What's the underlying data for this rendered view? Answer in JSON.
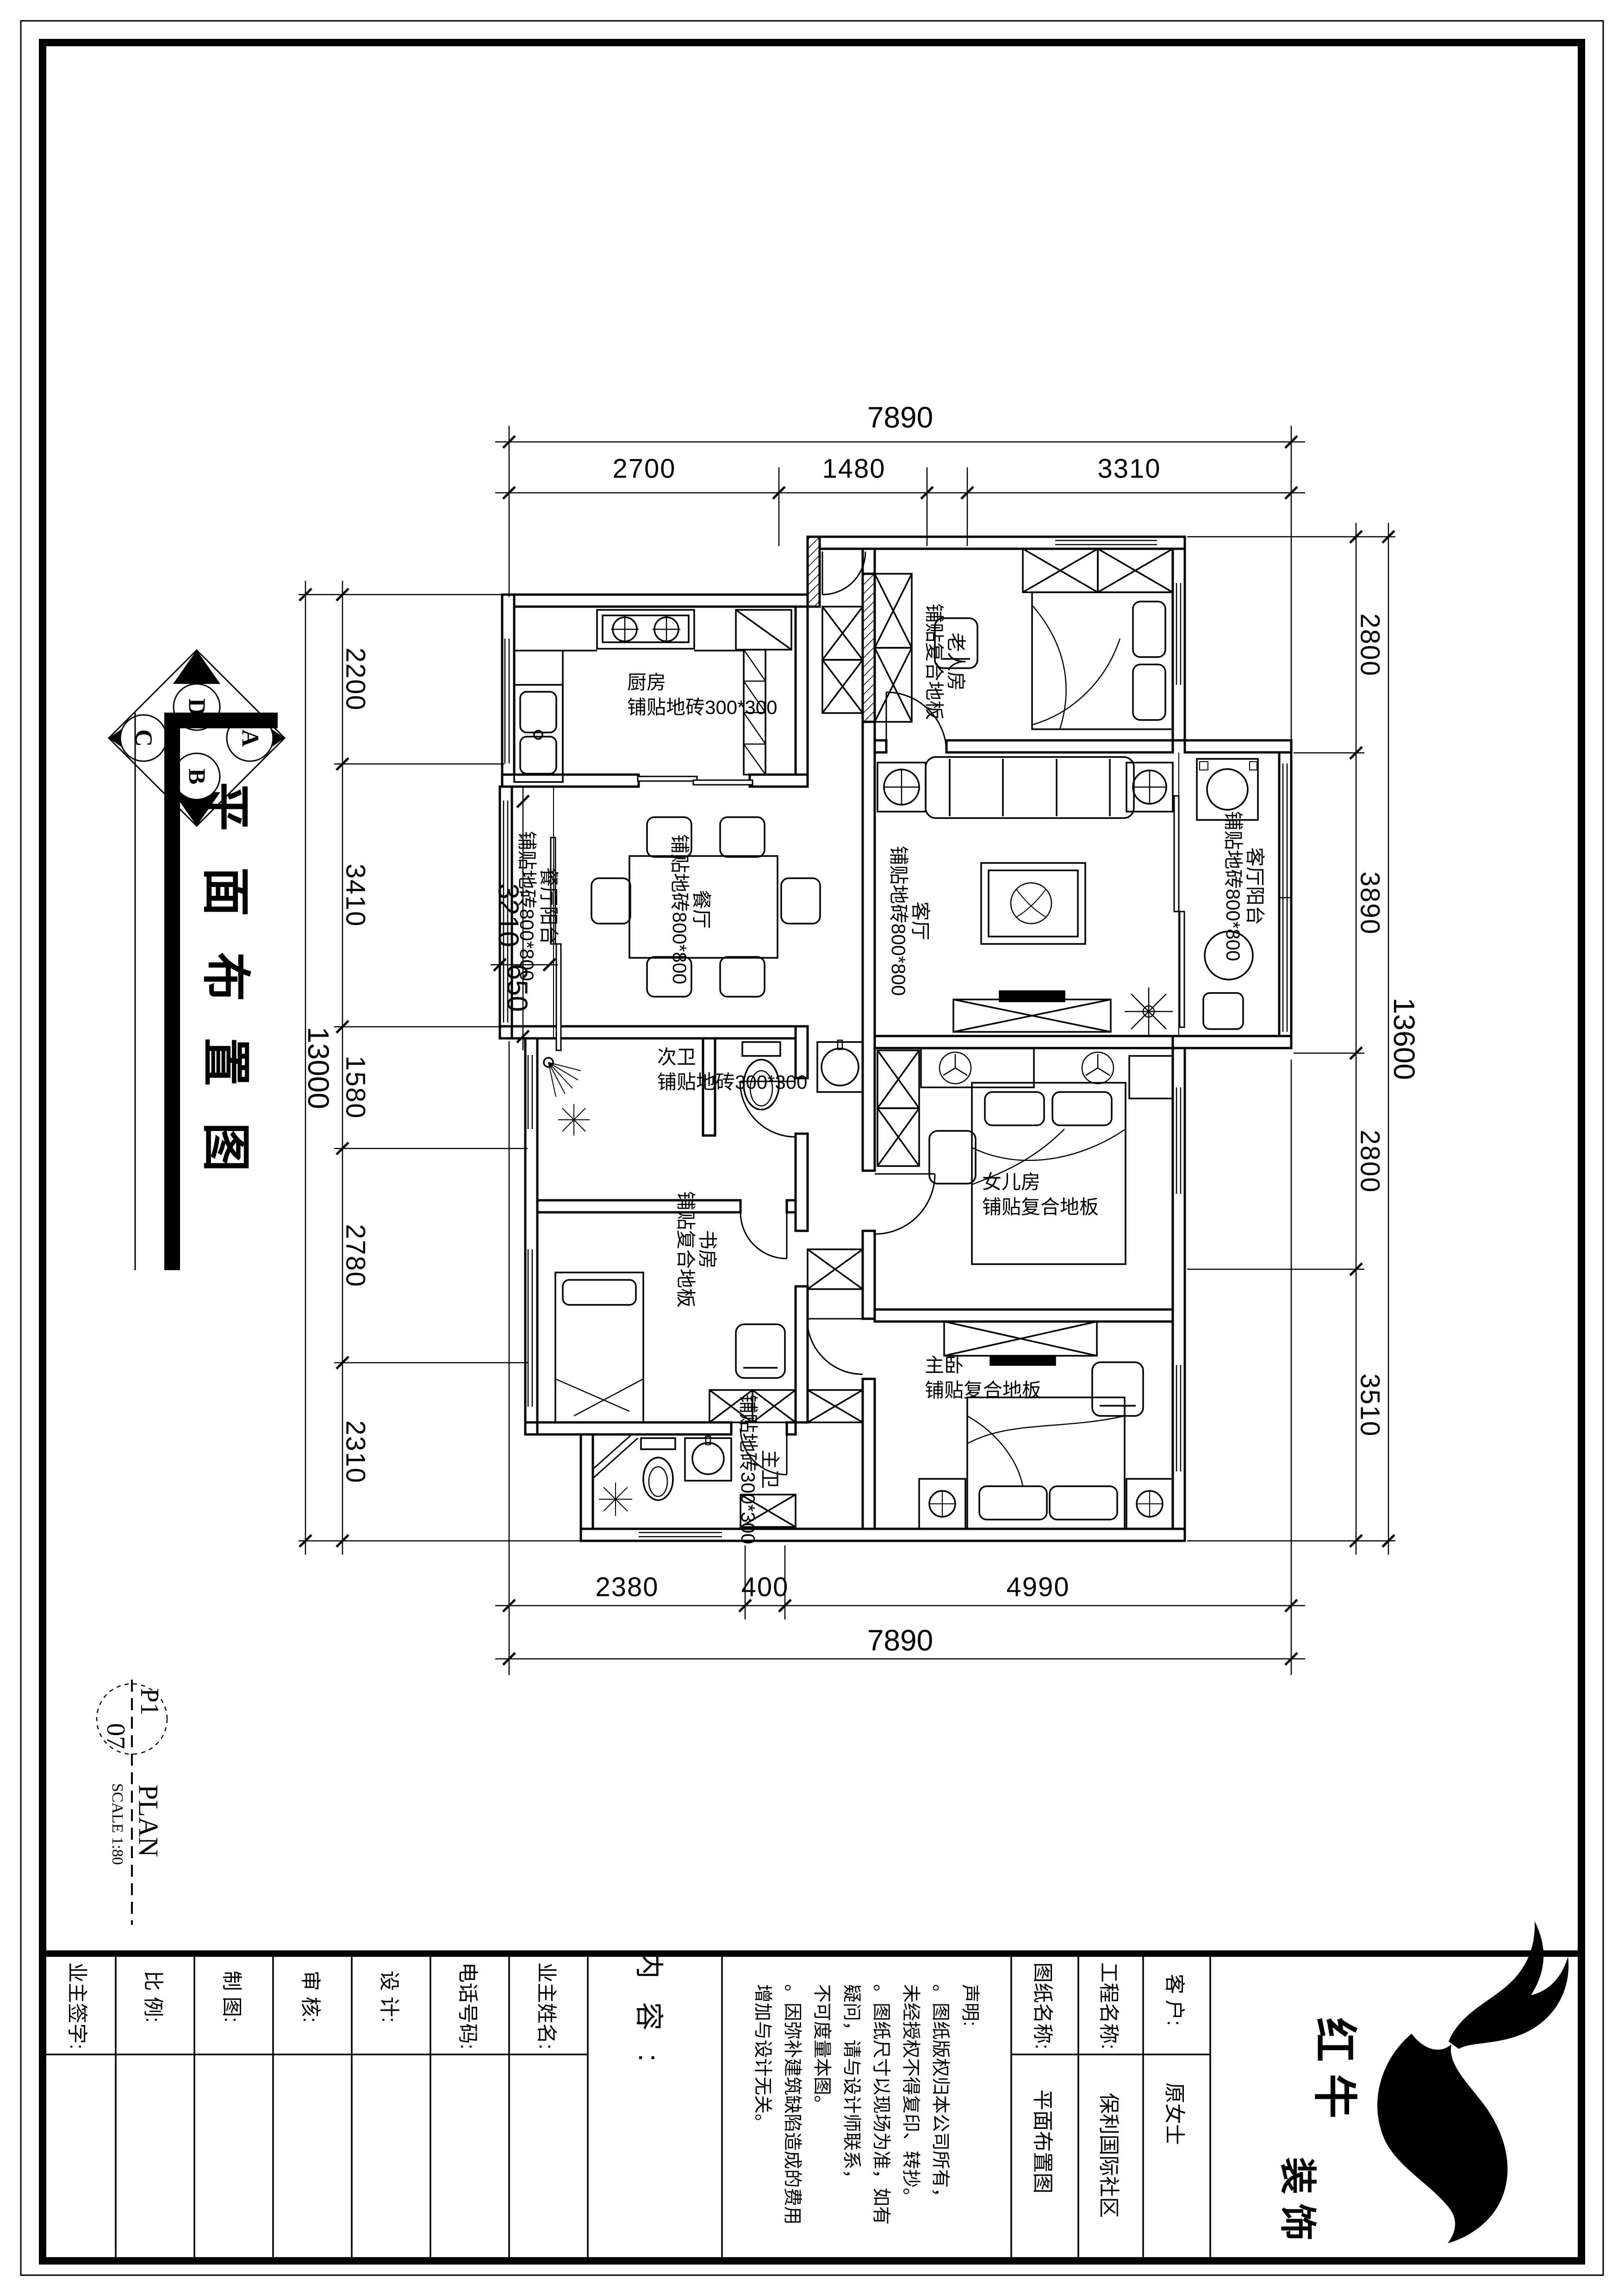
{
  "colors": {
    "ink": "#000000",
    "paper": "#ffffff"
  },
  "page_title": "平面布置图",
  "compass": {
    "top": "D",
    "right": "A",
    "bottom": "B",
    "left": "C"
  },
  "drawing_label": {
    "code_top": "P1",
    "code_bottom": "07",
    "name": "PLAN",
    "scale": "SCALE 1:80"
  },
  "dims": {
    "top_total": "7890",
    "top": [
      "2700",
      "1480",
      "3310"
    ],
    "bottom": [
      "2380",
      "400",
      "4990"
    ],
    "bottom_total": "7890",
    "left": [
      "2200",
      "3410",
      "1580",
      "2780",
      "2310"
    ],
    "left_total": "13000",
    "right": [
      "2800",
      "3890",
      "2800",
      "3510"
    ],
    "right_total": "13600",
    "interior": {
      "balcony_length": "3210",
      "balcony_width": "650"
    }
  },
  "rooms": [
    {
      "id": "kitchen",
      "name": "厨房",
      "floor": "铺贴地砖300*300"
    },
    {
      "id": "elder-room",
      "name": "老人房",
      "floor": "铺贴复合地板"
    },
    {
      "id": "living-room",
      "name": "客厅",
      "floor": "铺贴地砖800*800"
    },
    {
      "id": "living-balcony",
      "name": "客厅阳台",
      "floor": "铺贴地砖800*800"
    },
    {
      "id": "dining-room",
      "name": "餐厅",
      "floor": "铺贴地砖800*800"
    },
    {
      "id": "dining-balcony",
      "name": "餐厅阳台",
      "floor": "铺贴地砖800*800"
    },
    {
      "id": "second-bath",
      "name": "次卫",
      "floor": "铺贴地砖300*300"
    },
    {
      "id": "study",
      "name": "书房",
      "floor": "铺贴复合地板"
    },
    {
      "id": "daughter-room",
      "name": "女儿房",
      "floor": "铺贴复合地板"
    },
    {
      "id": "master-bedroom",
      "name": "主卧",
      "floor": "铺贴复合地板"
    },
    {
      "id": "master-bath",
      "name": "主卫",
      "floor": "铺贴地砖300*300"
    }
  ],
  "titleblock": {
    "fields": [
      {
        "label": "业主签字:"
      },
      {
        "label": "比 例:"
      },
      {
        "label": "制 图:"
      },
      {
        "label": "审 核:"
      },
      {
        "label": "设 计:"
      },
      {
        "label": "电话号码:"
      },
      {
        "label": "业主姓名:"
      }
    ],
    "content_label": "内容:",
    "declaration": {
      "lines": [
        "声明:",
        "。图纸版权归本公司所有，",
        "未经授权不得复印、转抄。",
        "。图纸尺寸以现场为准，如有",
        "疑问，请与设计师联系，",
        "不可度量本图。",
        "。因弥补建筑缺陷造成的费用",
        "增加与设计无关。"
      ]
    },
    "drawing_name": {
      "label": "图纸名称:",
      "value": "平面布置图"
    },
    "project": {
      "label": "工程名称:",
      "value": "保利国际社区"
    },
    "client": {
      "label": "客 户:",
      "value": "原女士"
    },
    "brand": {
      "main": "红牛",
      "sub": "装饰"
    }
  }
}
